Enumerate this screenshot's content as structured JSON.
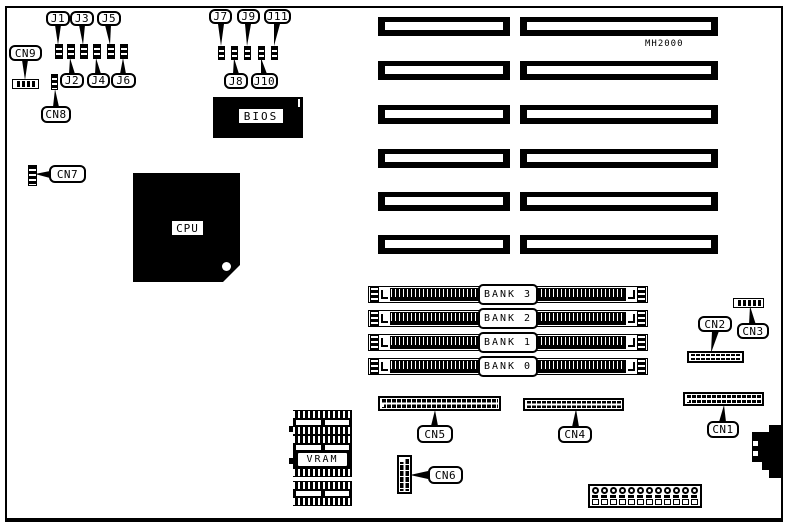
{
  "board": {
    "model": "MH2000"
  },
  "labels": {
    "j1": "J1",
    "j2": "J2",
    "j3": "J3",
    "j4": "J4",
    "j5": "J5",
    "j6": "J6",
    "j7": "J7",
    "j8": "J8",
    "j9": "J9",
    "j10": "J10",
    "j11": "J11",
    "cn1": "CN1",
    "cn2": "CN2",
    "cn3": "CN3",
    "cn4": "CN4",
    "cn5": "CN5",
    "cn6": "CN6",
    "cn7": "CN7",
    "cn8": "CN8",
    "cn9": "CN9",
    "cpu": "CPU",
    "bios": "BIOS",
    "vram": "VRAM"
  },
  "memory_banks": {
    "bank3": "BANK 3",
    "bank2": "BANK 2",
    "bank1": "BANK 1",
    "bank0": "BANK 0"
  },
  "expansion_slots": {
    "rows": 6,
    "columns": 2
  }
}
